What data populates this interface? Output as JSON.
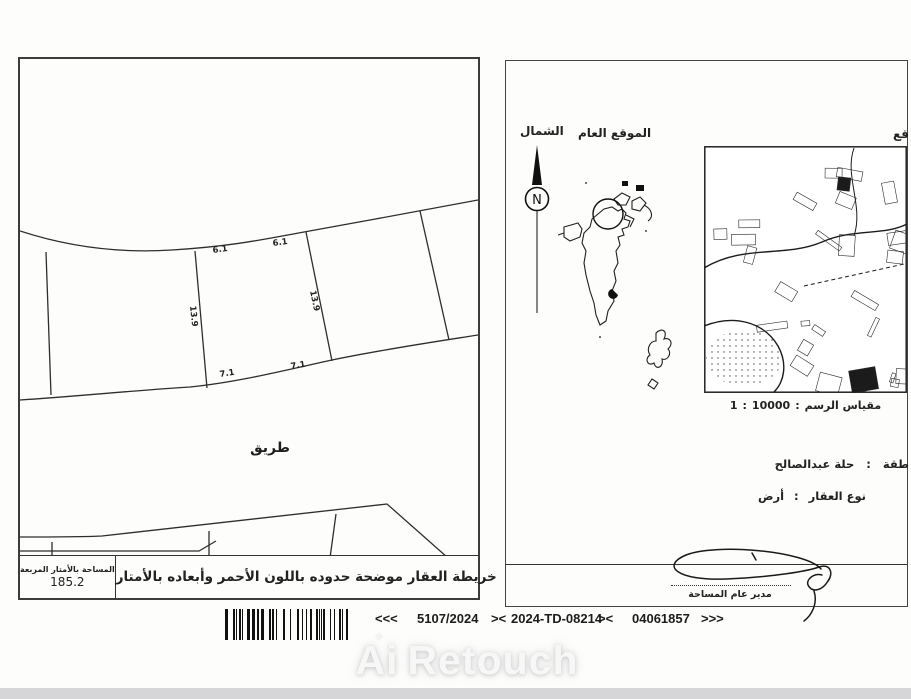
{
  "left_panel": {
    "dimensions": {
      "top_1": "6.1",
      "top_2": "6.1",
      "side_left": "13.9",
      "side_right": "13.9",
      "bottom_1": "7.1",
      "bottom_2": "7.1"
    },
    "road_label": "طريق",
    "area_box": {
      "label": "المساحة بالأمتار المربعة",
      "value": "185.2"
    },
    "note": "خريطة العقار موضحة حدوده باللون الأحمر وأبعاده بالأمتار"
  },
  "right_panel": {
    "north_label": "الشمال",
    "compass_letter": "N",
    "general_location_label": "الموقع العام",
    "clipped_label": "قع",
    "scale": {
      "label": "مقياس الرسم",
      "separator": ":",
      "denominator": "10000",
      "numerator": "1"
    },
    "region": {
      "label_clipped": "طقة",
      "separator": ":",
      "value": "حلة عبدالصالح"
    },
    "property_type": {
      "label": "نوع العقار",
      "separator": ":",
      "value": "أرض"
    },
    "signature_title": "مدير عام المساحة"
  },
  "footer": {
    "arrows_left": "<<<",
    "case_number": "5107/2024",
    "separator_a": "><",
    "td_number": "2024-TD-08214",
    "separator_b": "><",
    "serial": "04061857",
    "arrows_right": ">>>"
  },
  "watermark": {
    "part1": "Ai",
    "part2": "Retouch",
    "sparkle": "✦"
  },
  "colors": {
    "ink": "#222222",
    "paper": "#fdfdfc",
    "footer_bar": "#d6d6d8"
  }
}
